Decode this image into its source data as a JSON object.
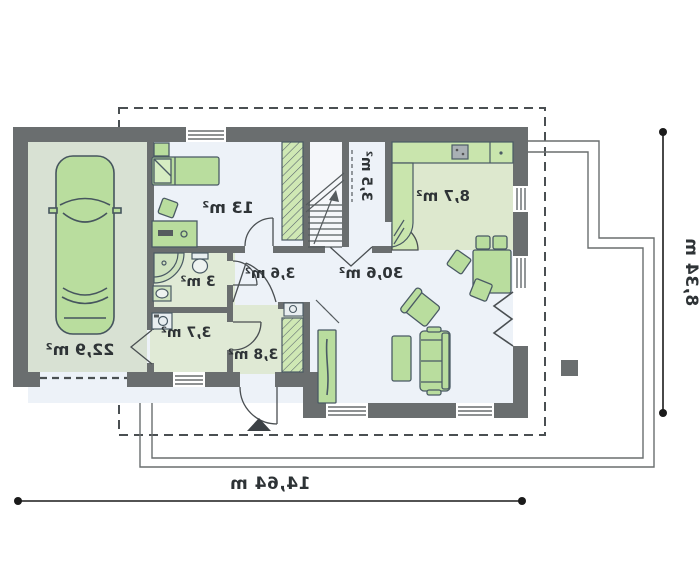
{
  "plan": {
    "rooms": [
      {
        "id": "garage",
        "area_label": "22,9 m²"
      },
      {
        "id": "bedroom",
        "area_label": "13 m²"
      },
      {
        "id": "bathroom",
        "area_label": "3 m²"
      },
      {
        "id": "utility",
        "area_label": "3,7 m²"
      },
      {
        "id": "vestibule",
        "area_label": "3,8 m²"
      },
      {
        "id": "hall",
        "area_label": "3,6 m²"
      },
      {
        "id": "storage",
        "area_label": "3,5 m²"
      },
      {
        "id": "kitchen",
        "area_label": "8,7 m²"
      },
      {
        "id": "living_room",
        "area_label": "30,6 m²"
      }
    ],
    "dimensions": {
      "overall_width": "14,64 m",
      "overall_depth": "8,34 m"
    },
    "colors": {
      "wall": "#6a6e6f",
      "furniture_green": "#b9dd9e",
      "floor_light": "#edf2f8",
      "floor_green": "#dfe9d4",
      "garage_floor": "#d8e1d3",
      "counter_green": "#c9e5ad",
      "dimension_line": "#1a1a1a"
    }
  }
}
